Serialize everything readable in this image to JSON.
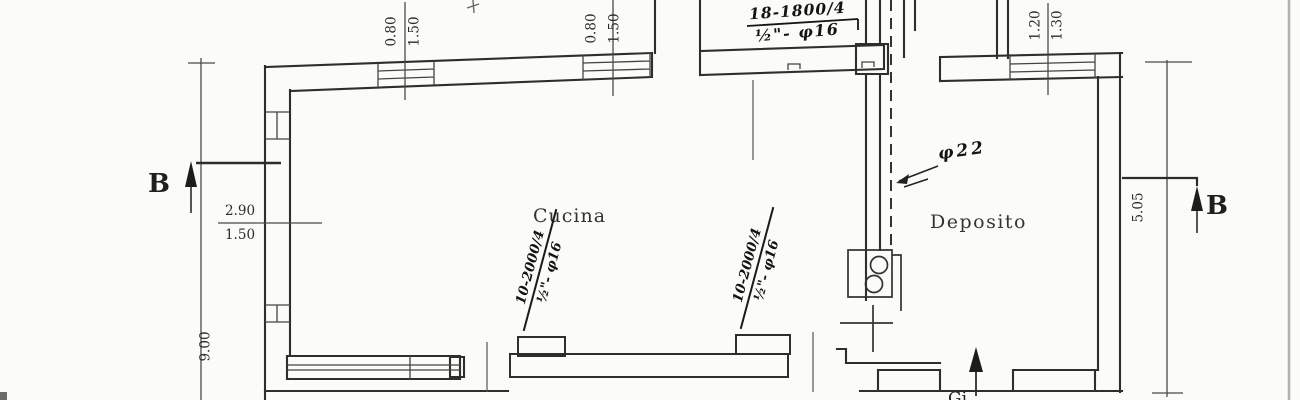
{
  "drawing": {
    "room_labels": {
      "kitchen": "Cucina",
      "storage": "Deposito"
    },
    "section_markers": {
      "left": "B",
      "right": "B"
    },
    "dimensions": {
      "top_window_left": {
        "first": "0.80",
        "second": "1.50"
      },
      "top_window_mid": {
        "first": "0.80",
        "second": "1.50"
      },
      "top_window_right": {
        "first": "1.20",
        "second": "1.30"
      },
      "left_opening": {
        "first": "2.90",
        "second": "1.50"
      },
      "left_side": "9.00",
      "right_side": "5.05"
    },
    "rebar_notes": {
      "top_slab": {
        "line1": "18-1800/4",
        "line2": "½\"- φ16"
      },
      "beam_left": {
        "line1": "10-2000/4",
        "line2": "½\"- φ16"
      },
      "beam_right": {
        "line1": "10-2000/4",
        "line2": "½\"- φ16"
      },
      "pipe": "φ22"
    },
    "clipped_label": "Gi"
  }
}
